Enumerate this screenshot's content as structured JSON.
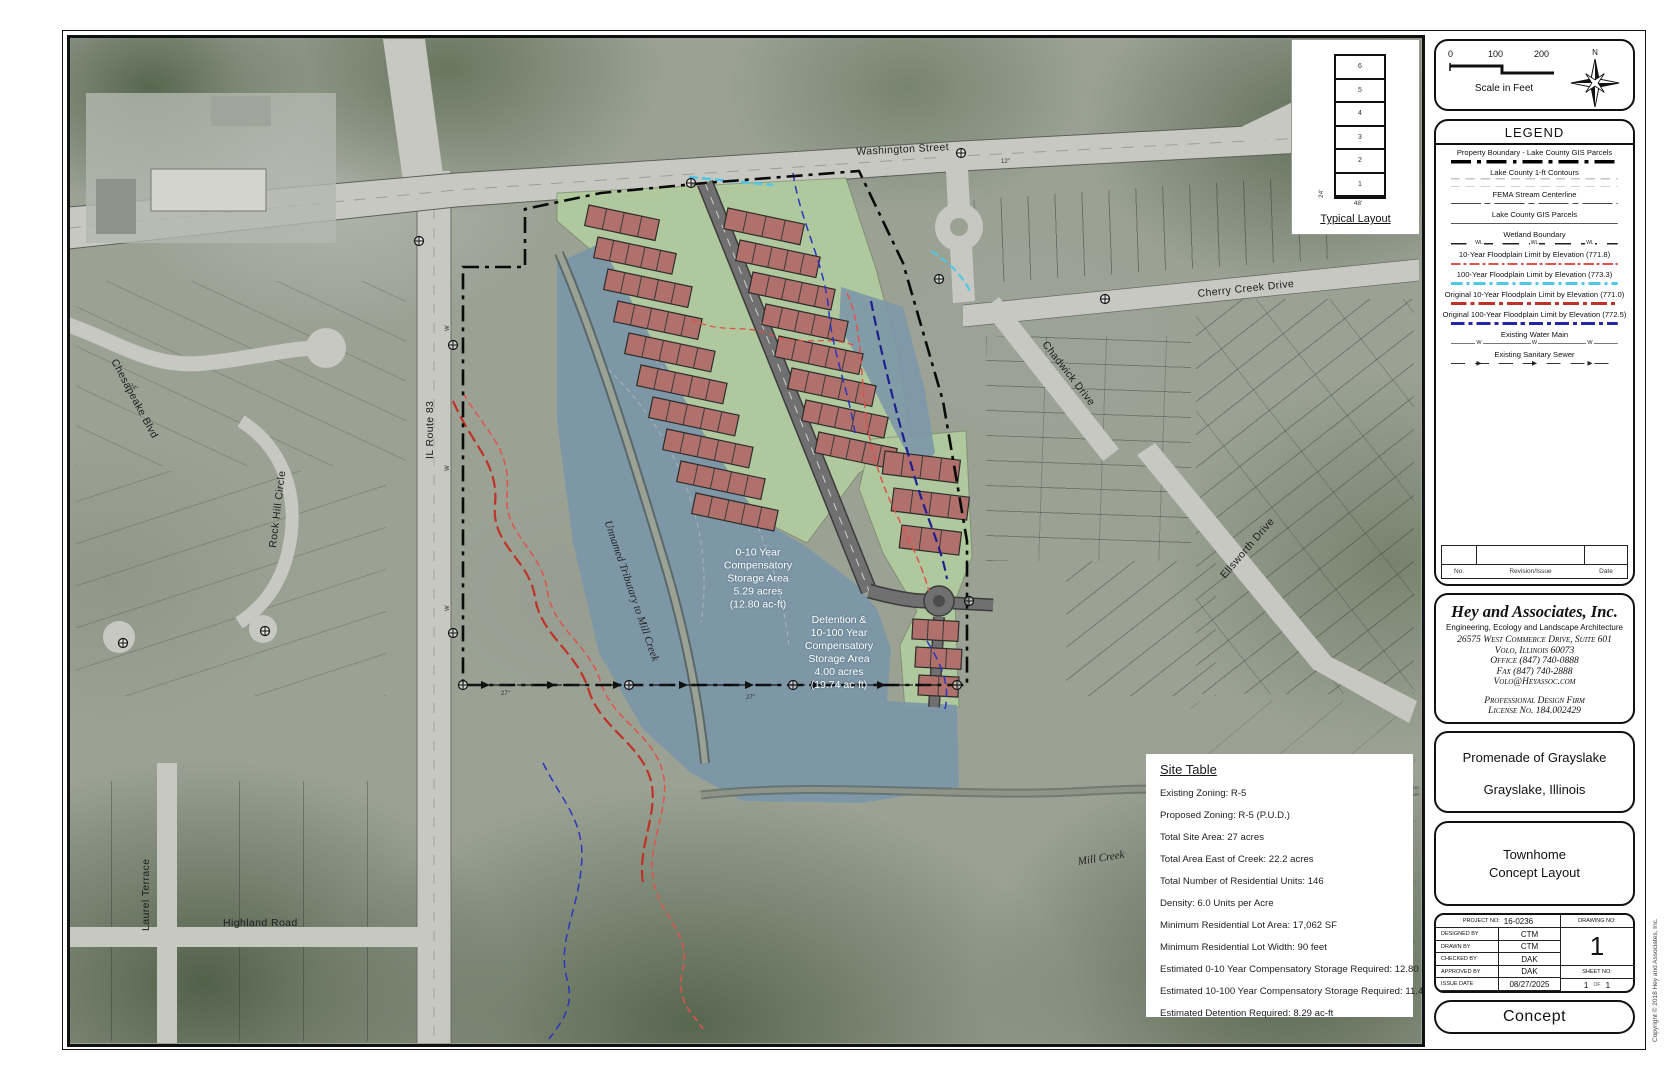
{
  "scale_bar": {
    "ticks": [
      "0",
      "100",
      "200"
    ],
    "label": "Scale in Feet",
    "north": "N"
  },
  "typical_layout": {
    "title": "Typical Layout",
    "units": [
      "6",
      "5",
      "4",
      "3",
      "2",
      "1"
    ],
    "width_label": "48'",
    "depth_label": "24'"
  },
  "legend": {
    "title": "LEGEND",
    "entries": [
      {
        "label": "Property Boundary - Lake County GIS Parcels",
        "style": "s-prop"
      },
      {
        "label": "Lake County 1-ft Contours",
        "style": "s-contour"
      },
      {
        "label": "FEMA Stream Centerline",
        "style": "s-fema"
      },
      {
        "label": "Lake County GIS Parcels",
        "style": "s-parcel"
      },
      {
        "label": "Wetland Boundary",
        "style": "s-wetland",
        "marker": "WL"
      },
      {
        "label": "10-Year Floodplain Limit by Elevation (771.8)",
        "style": "s-fp10"
      },
      {
        "label": "100-Year Floodplain Limit by Elevation (773.3)",
        "style": "s-fp100"
      },
      {
        "label": "Original 10-Year Floodplain Limit by Elevation (771.0)",
        "style": "s-ofp10"
      },
      {
        "label": "Original 100-Year Floodplain Limit by Elevation (772.5)",
        "style": "s-ofp100"
      },
      {
        "label": "Existing Water Main",
        "style": "s-water",
        "marker": "W"
      },
      {
        "label": "Existing Sanitary Sewer",
        "style": "s-sewer",
        "marker": "▶"
      }
    ],
    "revision": {
      "no": "No.",
      "issue": "Revision/Issue",
      "date": "Date"
    }
  },
  "firm": {
    "name": "Hey and Associates, Inc.",
    "tagline": "Engineering, Ecology and Landscape Architecture",
    "address": "26575 West Commerce Drive, Suite 601",
    "city": "Volo, Illinois  60073",
    "office": "Office (847) 740-0888",
    "fax": "Fax (847) 740-2888",
    "email": "Volo@Heyassoc.com",
    "prof1": "Professional Design Firm",
    "prof2": "License No. 184.002429"
  },
  "project": {
    "name1": "Promenade of Grayslake",
    "name2": "Grayslake, Illinois",
    "sheet1": "Townhome",
    "sheet2": "Concept Layout"
  },
  "title_block": {
    "project_no_label": "PROJECT NO:",
    "project_no": "16-0236",
    "drawing_no_label": "DRAWING NO:",
    "drawing_no": "1",
    "rows": [
      {
        "label": "DESIGNED BY",
        "value": "CTM"
      },
      {
        "label": "DRAWN BY",
        "value": "CTM"
      },
      {
        "label": "CHECKED BY",
        "value": "DAK"
      },
      {
        "label": "APPROVED BY",
        "value": "DAK"
      },
      {
        "label": "ISSUE DATE",
        "value": "08/27/2025"
      }
    ],
    "sheet_no_label": "SHEET NO:",
    "sheet": "1",
    "of_label": "OF",
    "sheet_total": "1"
  },
  "stamp": "Concept",
  "copyright": "Copyright © 2018 Hey and Associates, Inc.",
  "site_table": {
    "title": "Site Table",
    "rows": [
      "Existing Zoning: R-5",
      "Proposed Zoning: R-5 (P.U.D.)",
      "Total Site Area: 27 acres",
      "Total Area East of Creek: 22.2 acres",
      "Total Number of Residential Units: 146",
      "Density: 6.0 Units per Acre",
      "Minimum Residential Lot Area: 17,062 SF",
      "Minimum Residential Lot Width: 90 feet",
      "Estimated 0-10 Year Compensatory Storage Required: 12.80 ac-ft",
      "Estimated 10-100 Year Compensatory Storage Required: 11.45 ac-ft",
      "Estimated Detention Required: 8.29 ac-ft"
    ]
  },
  "map": {
    "colors": {
      "pond": "#7d97a8",
      "green": "#b2cb9e",
      "building": "#b0716c",
      "road": "#c6c8c1",
      "flood_red": "#e0534b",
      "flood_cyan": "#4fc7e8",
      "orig_red": "#bf3228",
      "orig_blue": "#2626a8"
    },
    "labels": [
      {
        "text": "Washington Street",
        "x": 855,
        "y": 145,
        "rot": -3,
        "cls": "road"
      },
      {
        "text": "Cherry Creek Drive",
        "x": 1196,
        "y": 287,
        "rot": -6,
        "cls": "road"
      },
      {
        "text": "Chadwick Drive",
        "x": 1048,
        "y": 338,
        "rot": 52,
        "cls": "road"
      },
      {
        "text": "Ellsworth Drive",
        "x": 1217,
        "y": 572,
        "rot": -49,
        "cls": "road"
      },
      {
        "text": "IL Route 83",
        "x": 423,
        "y": 458,
        "rot": -90,
        "cls": "road"
      },
      {
        "text": "Chesapeake Blvd",
        "x": 118,
        "y": 356,
        "rot": 62,
        "cls": "road"
      },
      {
        "text": "Rock Hill Circle",
        "x": 266,
        "y": 546,
        "rot": -83,
        "cls": "road"
      },
      {
        "text": "Laurel Terrace",
        "x": 139,
        "y": 930,
        "rot": -90,
        "cls": "road"
      },
      {
        "text": "Highland Road",
        "x": 222,
        "y": 916,
        "rot": 0,
        "cls": "road"
      },
      {
        "text": "Mill Creek",
        "x": 1076,
        "y": 855,
        "rot": -9,
        "cls": "creek"
      },
      {
        "text": "Unnamed Tributary to Mill Creek",
        "x": 612,
        "y": 518,
        "rot": 71,
        "cls": "creek"
      },
      {
        "text": "W",
        "x": 444,
        "y": 330,
        "rot": -90,
        "cls": "tiny"
      },
      {
        "text": "W",
        "x": 444,
        "y": 470,
        "rot": -90,
        "cls": "tiny"
      },
      {
        "text": "W",
        "x": 444,
        "y": 610,
        "rot": -90,
        "cls": "tiny"
      },
      {
        "text": "27\"",
        "x": 500,
        "y": 690,
        "rot": 0,
        "cls": "tiny"
      },
      {
        "text": "27\"",
        "x": 745,
        "y": 694,
        "rot": 0,
        "cls": "tiny"
      },
      {
        "text": "24\"",
        "x": 130,
        "y": 382,
        "rot": 30,
        "cls": "tiny"
      },
      {
        "text": "12\"",
        "x": 1000,
        "y": 158,
        "rot": 0,
        "cls": "tiny"
      }
    ],
    "pond_labels": [
      {
        "x": 757,
        "y": 578,
        "lines": [
          "0-10 Year",
          "Compensatory",
          "Storage Area",
          "5.29 acres",
          "(12.80 ac-ft)"
        ]
      },
      {
        "x": 838,
        "y": 652,
        "lines": [
          "Detention &",
          "10-100 Year",
          "Compensatory",
          "Storage Area",
          "4.00 acres",
          "(19.74 ac-ft)"
        ]
      }
    ],
    "buildings": [
      [
        588,
        204,
        72,
        21,
        12,
        4
      ],
      [
        597,
        236,
        80,
        21,
        12,
        5
      ],
      [
        607,
        268,
        86,
        21,
        12,
        5
      ],
      [
        617,
        300,
        86,
        21,
        12,
        5
      ],
      [
        628,
        332,
        88,
        21,
        12,
        5
      ],
      [
        640,
        364,
        88,
        21,
        12,
        5
      ],
      [
        652,
        396,
        88,
        21,
        12,
        5
      ],
      [
        666,
        428,
        88,
        21,
        12,
        5
      ],
      [
        680,
        460,
        86,
        21,
        12,
        5
      ],
      [
        695,
        492,
        84,
        21,
        12,
        5
      ],
      [
        727,
        207,
        78,
        21,
        12,
        4
      ],
      [
        739,
        239,
        82,
        21,
        12,
        5
      ],
      [
        752,
        271,
        84,
        21,
        12,
        5
      ],
      [
        765,
        303,
        84,
        21,
        12,
        5
      ],
      [
        778,
        335,
        86,
        21,
        12,
        5
      ],
      [
        791,
        367,
        86,
        21,
        12,
        5
      ],
      [
        805,
        399,
        84,
        21,
        12,
        5
      ],
      [
        818,
        431,
        80,
        21,
        12,
        5
      ],
      [
        884,
        450,
        76,
        23,
        7,
        4
      ],
      [
        893,
        487,
        76,
        23,
        7,
        4
      ],
      [
        901,
        524,
        60,
        23,
        7,
        3
      ],
      [
        912,
        618,
        46,
        20,
        3,
        3
      ],
      [
        915,
        646,
        46,
        20,
        3,
        3
      ],
      [
        918,
        674,
        40,
        20,
        3,
        2
      ]
    ]
  }
}
